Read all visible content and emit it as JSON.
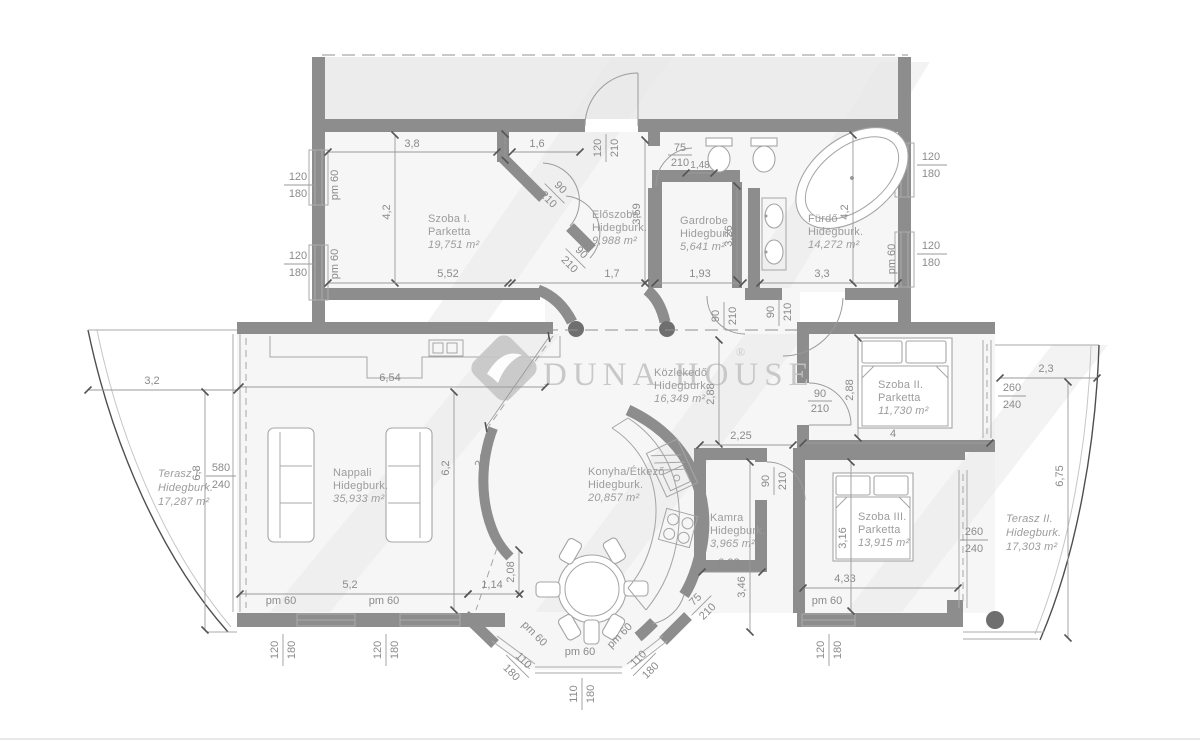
{
  "watermark": {
    "brand": "DUNA HOUSE",
    "registered": "®"
  },
  "rooms": {
    "szoba1": {
      "name": "Szoba I.",
      "floor": "Parketta",
      "area": "19,751 m²"
    },
    "eloszoba": {
      "name": "Előszoba",
      "floor": "Hidegburk.",
      "area": "9,988 m²"
    },
    "gardrobe": {
      "name": "Gardrobe",
      "floor": "Hidegburk.",
      "area": "5,641 m²"
    },
    "furdo": {
      "name": "Fürdő",
      "floor": "Hidegburk.",
      "area": "14,272 m²"
    },
    "kozlekedo": {
      "name": "Közlekedő",
      "floor": "Hidegburk.",
      "area": "16,349 m²"
    },
    "szoba2": {
      "name": "Szoba II.",
      "floor": "Parketta",
      "area": "11,730 m²"
    },
    "terasz1": {
      "name": "Terasz I.",
      "floor": "Hidegburk.",
      "area": "17,287 m²"
    },
    "nappali": {
      "name": "Nappali",
      "floor": "Hidegburk.",
      "area": "35,933 m²"
    },
    "konyha": {
      "name": "Konyha/Étkező",
      "floor": "Hidegburk.",
      "area": "20,857 m²"
    },
    "kamra": {
      "name": "Kamra",
      "floor": "Hidegburk.",
      "area": "3,965 m²"
    },
    "szoba3": {
      "name": "Szoba III.",
      "floor": "Parketta",
      "area": "13,915 m²"
    },
    "terasz2": {
      "name": "Terasz II.",
      "floor": "Hidegburk.",
      "area": "17,303 m²"
    }
  },
  "dims": {
    "d38": "3,8",
    "d081": "0,81",
    "d16": "1,6",
    "d148": "1,48",
    "d42": "4,2",
    "d552": "5,52",
    "d359": "3,59",
    "d17": "1,7",
    "d193": "1,93",
    "d326": "3,26",
    "d33": "3,3",
    "d288": "2,88",
    "d225": "2,25",
    "d4": "4",
    "d23": "2,3",
    "d675": "6,75",
    "d32": "3,2",
    "d68": "6,8",
    "d654": "6,54",
    "d62": "6,2",
    "d236": "2,36",
    "d52": "5,2",
    "d114": "1,14",
    "d208": "2,08",
    "d092": "0,92",
    "d346": "3,46",
    "d316": "3,16",
    "d433": "4,33"
  },
  "openings": {
    "pm60": "pm 60",
    "w120": "120",
    "w110": "110",
    "w90": "90",
    "w75": "75",
    "w260": "260",
    "w580": "580",
    "h180": "180",
    "h210": "210",
    "h240": "240"
  },
  "colors": {
    "wall": "#8d8d8d",
    "wall_dark": "#6f6f6f",
    "dimension_text": "#8b8b8b",
    "room_label": "#9c9c9c",
    "watermark_gray": "#e9e9e9",
    "logo_gray": "#c4c4c4"
  }
}
